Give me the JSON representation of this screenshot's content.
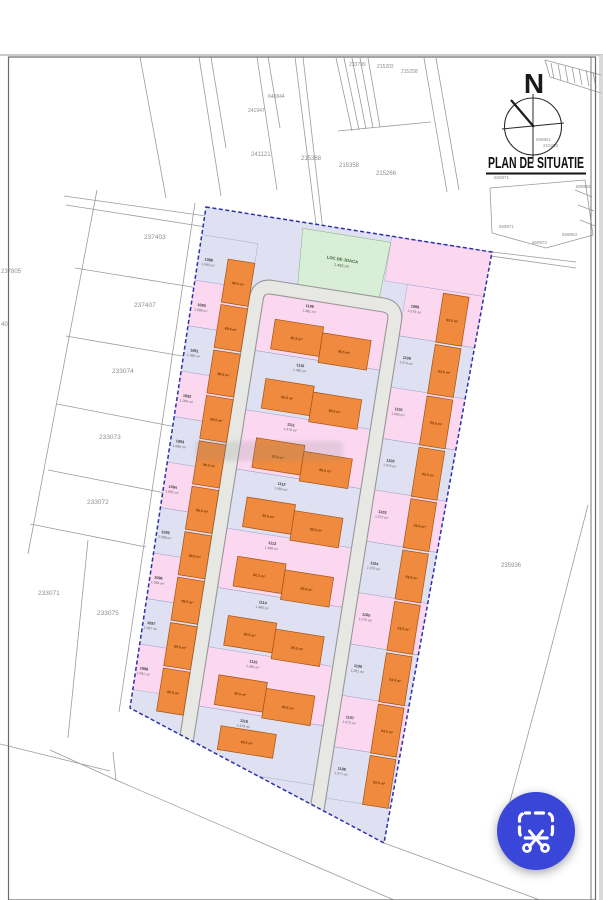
{
  "page": {
    "background": "#ffffff",
    "divider_color": "#c9c9c9",
    "photo_edge": "#d9d9d9",
    "frame_color": "#6a6a6a",
    "line_color": "#9b9b9b",
    "label_color": "#8d8d8d"
  },
  "titleblock": {
    "north": "N",
    "title": "PLAN DE SITUATIE"
  },
  "site": {
    "boundary_color": "#2b31a8",
    "fill_lavender": "#dfe0f2",
    "fill_pink": "#fbd7f0",
    "fill_green": "#d9eed6",
    "fill_orange": "#ef8a3e",
    "house_stroke": "#a35312",
    "road_fill": "#e7e7e3",
    "road_edge": "#979797",
    "playground": {
      "name": "LOC DE JOACA",
      "area": "1.483 m²"
    },
    "left_plots": [
      {
        "no": "1089",
        "area": "1.093 m²",
        "house": "89.5 m²"
      },
      {
        "no": "1090",
        "area": "1.088 m²",
        "house": "89.5 m²"
      },
      {
        "no": "1091",
        "area": "1.095 m²",
        "house": "89.5 m²"
      },
      {
        "no": "1092",
        "area": "1.090 m²",
        "house": "89.5 m²"
      },
      {
        "no": "1093",
        "area": "1.086 m²",
        "house": "89.5 m²"
      },
      {
        "no": "1094",
        "area": "1.092 m²",
        "house": "89.5 m²"
      },
      {
        "no": "1095",
        "area": "1.089 m²",
        "house": "89.5 m²"
      },
      {
        "no": "1096",
        "area": "1.094 m²",
        "house": "89.5 m²"
      },
      {
        "no": "1097",
        "area": "1.087 m²",
        "house": "89.5 m²"
      },
      {
        "no": "1098",
        "area": "1.091 m²",
        "house": "89.5 m²"
      }
    ],
    "right_plots": [
      {
        "no": "1099",
        "area": "1.078 m²",
        "house": "93.5 m²"
      },
      {
        "no": "1100",
        "area": "1.074 m²",
        "house": "93.5 m²"
      },
      {
        "no": "1101",
        "area": "1.080 m²",
        "house": "93.5 m²"
      },
      {
        "no": "1102",
        "area": "1.076 m²",
        "house": "93.5 m²"
      },
      {
        "no": "1103",
        "area": "1.072 m²",
        "house": "93.5 m²"
      },
      {
        "no": "1104",
        "area": "1.079 m²",
        "house": "93.5 m²"
      },
      {
        "no": "1105",
        "area": "1.075 m²",
        "house": "93.5 m²"
      },
      {
        "no": "1106",
        "area": "1.081 m²",
        "house": "93.5 m²"
      },
      {
        "no": "1107",
        "area": "1.073 m²",
        "house": "93.5 m²"
      },
      {
        "no": "1108",
        "area": "1.077 m²",
        "house": "93.5 m²"
      }
    ],
    "center_rows": [
      {
        "no": "1109",
        "area": "1.481 m²",
        "houses": [
          "92.5 m²",
          "95.5 m²"
        ]
      },
      {
        "no": "1110",
        "area": "1.485 m²",
        "houses": [
          "92.5 m²",
          "95.5 m²"
        ]
      },
      {
        "no": "1111",
        "area": "1.479 m²",
        "houses": [
          "92.5 m²",
          "95.5 m²"
        ]
      },
      {
        "no": "1112",
        "area": "1.483 m²",
        "houses": [
          "92.5 m²",
          "95.5 m²"
        ]
      },
      {
        "no": "1113",
        "area": "1.486 m²",
        "houses": [
          "92.5 m²",
          "95.5 m²"
        ]
      },
      {
        "no": "1114",
        "area": "1.480 m²",
        "houses": [
          "92.5 m²",
          "95.5 m²"
        ]
      },
      {
        "no": "1115",
        "area": "1.484 m²",
        "houses": [
          "92.5 m²",
          "95.5 m²"
        ]
      },
      {
        "no": "1116",
        "area": "1.478 m²",
        "houses": [
          "88.5 m²"
        ]
      }
    ],
    "bottom_plot": {
      "no": "1117",
      "area": "1.476 m²"
    }
  },
  "cadastral_labels": [
    {
      "t": "237403",
      "x": 144,
      "y": 239,
      "s": 6.5
    },
    {
      "t": "237805",
      "x": 1,
      "y": 273,
      "s": 6
    },
    {
      "t": "40",
      "x": 1,
      "y": 326,
      "s": 6
    },
    {
      "t": "237407",
      "x": 134,
      "y": 307,
      "s": 6.5
    },
    {
      "t": "233074",
      "x": 112,
      "y": 373,
      "s": 6.5
    },
    {
      "t": "233073",
      "x": 99,
      "y": 439,
      "s": 6.5
    },
    {
      "t": "233072",
      "x": 87,
      "y": 504,
      "s": 6.5
    },
    {
      "t": "233071",
      "x": 38,
      "y": 595,
      "s": 6.5
    },
    {
      "t": "233075",
      "x": 97,
      "y": 615,
      "s": 6.5
    },
    {
      "t": "235936",
      "x": 501,
      "y": 567,
      "s": 6
    },
    {
      "t": "241121",
      "x": 251,
      "y": 156,
      "s": 6
    },
    {
      "t": "241947",
      "x": 248,
      "y": 112,
      "s": 5
    },
    {
      "t": "640844",
      "x": 268,
      "y": 98,
      "s": 5
    },
    {
      "t": "233789",
      "x": 349,
      "y": 66,
      "s": 5
    },
    {
      "t": "215202",
      "x": 377,
      "y": 68,
      "s": 5
    },
    {
      "t": "215258",
      "x": 401,
      "y": 73,
      "s": 5
    },
    {
      "t": "215368",
      "x": 301,
      "y": 160,
      "s": 6
    },
    {
      "t": "215358",
      "x": 339,
      "y": 167,
      "s": 6
    },
    {
      "t": "215266",
      "x": 376,
      "y": 175,
      "s": 6
    },
    {
      "t": "659851",
      "x": 536,
      "y": 141,
      "s": 4.5
    },
    {
      "t": "215203",
      "x": 543,
      "y": 147,
      "s": 4.5
    },
    {
      "t": "659871",
      "x": 494,
      "y": 179,
      "s": 4.5
    },
    {
      "t": "659871",
      "x": 499,
      "y": 228,
      "s": 4.5
    },
    {
      "t": "659872",
      "x": 532,
      "y": 244,
      "s": 4.5
    },
    {
      "t": "659853",
      "x": 562,
      "y": 236,
      "s": 4.5
    },
    {
      "t": "899885",
      "x": 576,
      "y": 188,
      "s": 4.5
    }
  ],
  "fab": {
    "color": "#3a46d8",
    "icon": "smart-select-scissors"
  }
}
